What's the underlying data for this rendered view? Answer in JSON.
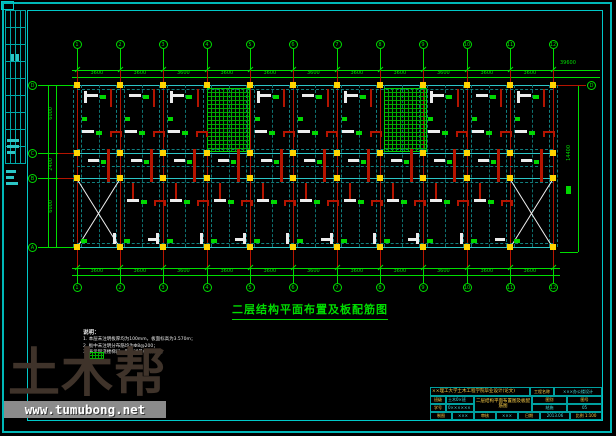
{
  "plan": {
    "title": "二层结构平面布置及板配筋图",
    "axes_top": [
      "1",
      "2",
      "3",
      "4",
      "5",
      "6",
      "7",
      "8",
      "9",
      "10",
      "11",
      "12"
    ],
    "axes_bottom": [
      "1",
      "2",
      "3",
      "4",
      "5",
      "6",
      "7",
      "8",
      "9",
      "10",
      "11",
      "12"
    ],
    "axes_left": [
      "D",
      "C",
      "B",
      "A"
    ],
    "axis_right_label": "D",
    "dim_top": [
      "3600",
      "3600",
      "3600",
      "3600",
      "3600",
      "3600",
      "3600",
      "3600",
      "3600",
      "3600",
      "3600"
    ],
    "dim_bottom": [
      "3600",
      "3600",
      "3600",
      "3600",
      "3600",
      "3600",
      "3600",
      "3600",
      "3600",
      "3600",
      "3600"
    ],
    "dim_left": [
      "6000",
      "2400",
      "6000"
    ],
    "dim_top_total": "39600",
    "dim_right_total": "14400"
  },
  "notes": {
    "header": "说明：",
    "items": [
      "1. 本层未注明板厚均为100mm，板面标高为3.570m；",
      "2. 板中未注明分布筋均为Φ8@200；",
      "3.          表示现浇楼梯间，配筋详见楼梯详图。"
    ]
  },
  "title_block": {
    "school_row": "××理工大学土木工程学院毕业设计(论文)",
    "project_label": "工程名称",
    "project_value": "×××办公楼设计",
    "class_label": "班级",
    "class_value": "土木0×班",
    "id_label": "学号",
    "id_value": "0××××××",
    "drawing_name": "二层结构平面布置图及板配筋图",
    "sheet_type_label": "图别",
    "sheet_type_value": "结施",
    "sheet_no_label": "图号",
    "sheet_no_value": "05",
    "bottom_cells": [
      "制图",
      "×××",
      "审核",
      "×××",
      "日期",
      "2013.06",
      "比例 1:100"
    ]
  },
  "watermark": {
    "logo": "土木帮",
    "url": "www.tumubong.net"
  },
  "colors": {
    "frame_cyan": "#00c8c8",
    "grid_green": "#00dd00",
    "column_red": "#b41400",
    "column_yellow": "#ffd400",
    "beam_white": "#ececec",
    "hatch_green": "#00aa00",
    "watermark_brown": "#3f332a",
    "watermark_bar": "#8b8b8b"
  }
}
